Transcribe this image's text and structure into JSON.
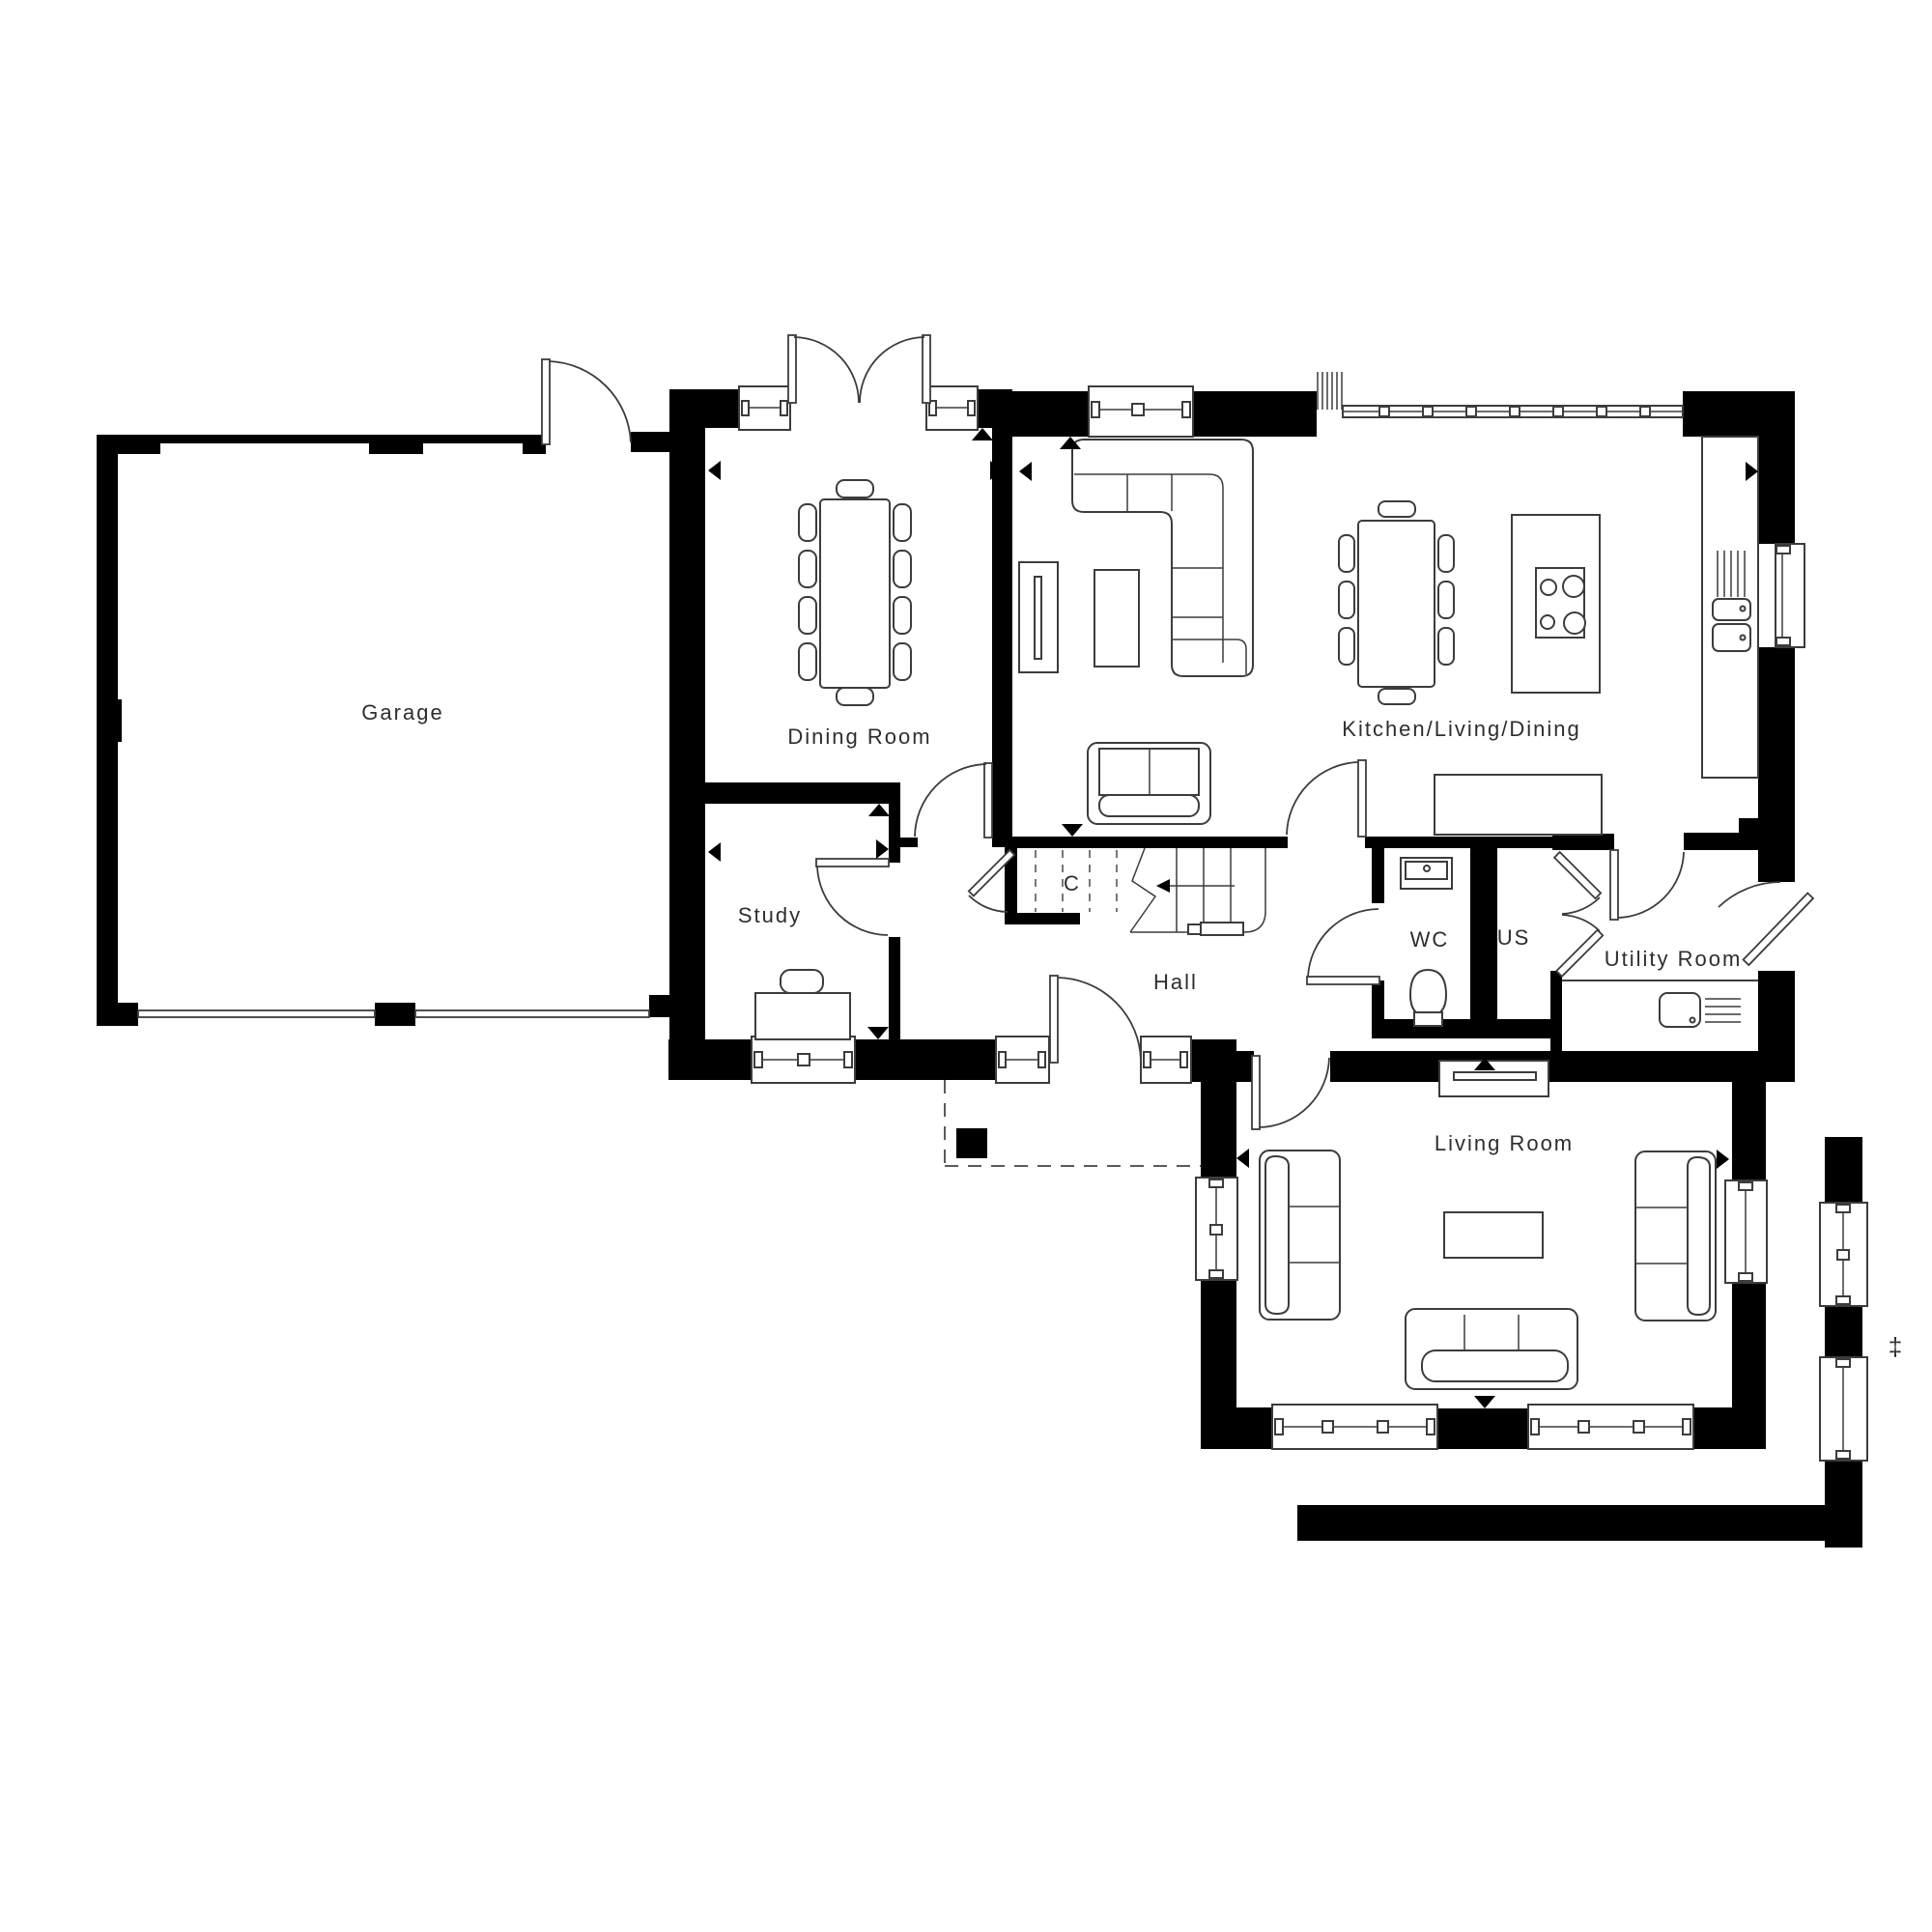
{
  "figure": {
    "kind": "architectural-floor-plan",
    "floor": "ground floor",
    "background": "#ffffff"
  },
  "colors": {
    "walls": "#000000",
    "linework": "#3c3c3c",
    "text": "#2e2e2e"
  },
  "rooms": {
    "garage": {
      "label": "Garage"
    },
    "dining_room": {
      "label": "Dining Room"
    },
    "kitchen_living_dining": {
      "label": "Kitchen/Living/Dining"
    },
    "study": {
      "label": "Study"
    },
    "hall": {
      "label": "Hall"
    },
    "under_stairs_cupboard": {
      "label": "C"
    },
    "wc": {
      "label": "WC"
    },
    "us": {
      "label": "US"
    },
    "utility_room": {
      "label": "Utility Room"
    },
    "living_room": {
      "label": "Living Room"
    }
  },
  "annotations": {
    "plot_position_marker": "‡"
  }
}
